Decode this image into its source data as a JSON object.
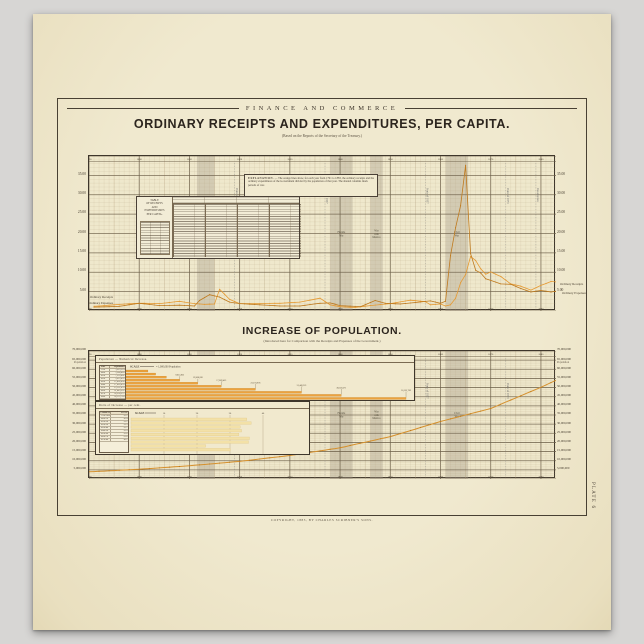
{
  "header": {
    "running_head": "FINANCE AND COMMERCE",
    "title": "ORDINARY RECEIPTS AND EXPENDITURES, PER CAPITA.",
    "subtitle": "(Based on the Reports of the Secretary of the Treasury.)"
  },
  "section2": {
    "title": "INCREASE OF POPULATION.",
    "subtitle": "(Introduced here for Comparison with the Receipts and Expenses of the Government.)"
  },
  "footer": {
    "copyright": "COPYRIGHT, 1883, BY CHARLES SCRIBNER'S SONS.",
    "plate_label": "PLATE 6"
  },
  "explanation_box": {
    "title": "EXPLANATION.",
    "body": "— The orange lines show, for each year from 1791 to 1883, the ordinary receipts and the ordinary expenditures of the Government divided by the population of that year. The shaded columns mark periods of war."
  },
  "top_table": {
    "header_lines": [
      "TABLE",
      "OF RECEIPTS",
      "AND",
      "EXPENDITURES",
      "PER CAPITA."
    ]
  },
  "series_labels": {
    "receipts": "Ordinary Receipts",
    "expenses": "Ordinary Expenses"
  },
  "colors": {
    "paper": "#efe8cc",
    "ink": "#3b332a",
    "grid_fine": "#b3a07c",
    "grid_heavy": "#6e604a",
    "receipts": "#e59a33",
    "expenses": "#bf7a1e",
    "population_line": "#d6902c",
    "war_band": "#a59c8b",
    "bar_orange": "#eca23e",
    "bar_pale": "#f3e1a7"
  },
  "chart_data": [
    {
      "type": "line",
      "title": "Ordinary Receipts and Expenditures, per Capita",
      "x_range": [
        1790,
        1883
      ],
      "x_ticks": [
        1790,
        1800,
        1810,
        1820,
        1830,
        1840,
        1850,
        1860,
        1870,
        1880
      ],
      "ylim": [
        0,
        40
      ],
      "y_ticks": [
        {
          "v": 35,
          "label": "35.00"
        },
        {
          "v": 30,
          "label": "30.00"
        },
        {
          "v": 25,
          "label": "25.00"
        },
        {
          "v": 20,
          "label": "20.00"
        },
        {
          "v": 15,
          "label": "15.00"
        },
        {
          "v": 10,
          "label": "10.00"
        },
        {
          "v": 5,
          "label": "5.00"
        }
      ],
      "grid": "yearly verticals, $1 horizontals, heavy every 5",
      "legend_position": "right and left of frame",
      "war_bands": [
        {
          "label": "War of 1812",
          "start": 1811.5,
          "end": 1815
        },
        {
          "label": "Florida War",
          "start": 1838,
          "end": 1842.5
        },
        {
          "label": "War with Mexico",
          "start": 1846,
          "end": 1848.5
        },
        {
          "label": "Civil War",
          "start": 1861,
          "end": 1865.5
        }
      ],
      "events": [
        {
          "year": 1819,
          "label": "Panic of 1819"
        },
        {
          "year": 1837,
          "label": "Panic of 1837"
        },
        {
          "year": 1857,
          "label": "Panic of 1857"
        },
        {
          "year": 1873,
          "label": "Panic of 1873"
        },
        {
          "year": 1879,
          "label": "Resumption"
        }
      ],
      "series": [
        {
          "name": "Ordinary Receipts",
          "color": "#e59a33",
          "points": [
            [
              1791,
              1.2
            ],
            [
              1796,
              1.7
            ],
            [
              1800,
              2.0
            ],
            [
              1804,
              1.9
            ],
            [
              1808,
              2.5
            ],
            [
              1811,
              1.9
            ],
            [
              1813,
              1.7
            ],
            [
              1815,
              1.8
            ],
            [
              1816,
              5.6
            ],
            [
              1818,
              3.0
            ],
            [
              1820,
              1.9
            ],
            [
              1824,
              1.9
            ],
            [
              1828,
              2.0
            ],
            [
              1832,
              2.3
            ],
            [
              1836,
              3.3
            ],
            [
              1838,
              1.6
            ],
            [
              1840,
              1.1
            ],
            [
              1843,
              0.9
            ],
            [
              1846,
              1.4
            ],
            [
              1850,
              1.9
            ],
            [
              1854,
              2.8
            ],
            [
              1857,
              2.4
            ],
            [
              1858,
              1.6
            ],
            [
              1860,
              1.8
            ],
            [
              1861,
              1.3
            ],
            [
              1862,
              1.6
            ],
            [
              1863,
              3.3
            ],
            [
              1864,
              7.3
            ],
            [
              1865,
              9.4
            ],
            [
              1866,
              14.1
            ],
            [
              1867,
              13.0
            ],
            [
              1868,
              10.9
            ],
            [
              1869,
              9.5
            ],
            [
              1870,
              10.1
            ],
            [
              1872,
              8.9
            ],
            [
              1874,
              7.0
            ],
            [
              1876,
              6.4
            ],
            [
              1878,
              5.4
            ],
            [
              1880,
              6.6
            ],
            [
              1882,
              7.6
            ],
            [
              1883,
              7.5
            ]
          ]
        },
        {
          "name": "Ordinary Expenses",
          "color": "#bf7a1e",
          "points": [
            [
              1791,
              1.0
            ],
            [
              1796,
              1.2
            ],
            [
              1800,
              2.0
            ],
            [
              1804,
              1.4
            ],
            [
              1808,
              1.5
            ],
            [
              1811,
              1.3
            ],
            [
              1812,
              2.7
            ],
            [
              1814,
              4.2
            ],
            [
              1816,
              3.6
            ],
            [
              1818,
              2.3
            ],
            [
              1820,
              1.9
            ],
            [
              1824,
              1.6
            ],
            [
              1828,
              1.3
            ],
            [
              1832,
              1.3
            ],
            [
              1836,
              2.0
            ],
            [
              1838,
              2.1
            ],
            [
              1840,
              1.4
            ],
            [
              1844,
              1.1
            ],
            [
              1847,
              2.7
            ],
            [
              1849,
              2.0
            ],
            [
              1852,
              1.8
            ],
            [
              1855,
              2.2
            ],
            [
              1858,
              2.6
            ],
            [
              1860,
              2.0
            ],
            [
              1861,
              2.5
            ],
            [
              1862,
              14.3
            ],
            [
              1863,
              21.5
            ],
            [
              1864,
              27.2
            ],
            [
              1865,
              37.6
            ],
            [
              1866,
              14.8
            ],
            [
              1867,
              10.5
            ],
            [
              1868,
              9.8
            ],
            [
              1869,
              8.3
            ],
            [
              1870,
              7.9
            ],
            [
              1872,
              7.0
            ],
            [
              1874,
              6.9
            ],
            [
              1876,
              5.8
            ],
            [
              1878,
              4.9
            ],
            [
              1880,
              5.3
            ],
            [
              1882,
              4.9
            ],
            [
              1883,
              5.1
            ]
          ]
        }
      ]
    },
    {
      "type": "line",
      "title": "Increase of Population",
      "x_range": [
        1790,
        1883
      ],
      "x_ticks": [
        1790,
        1800,
        1810,
        1820,
        1830,
        1840,
        1850,
        1860,
        1870,
        1880
      ],
      "ylim_millions": [
        0,
        70
      ],
      "y_ticks": [
        {
          "v": 70,
          "label": "70,000,000"
        },
        {
          "v": 65,
          "label": "65,000,000",
          "sub": "Population"
        },
        {
          "v": 60,
          "label": "60,000,000"
        },
        {
          "v": 55,
          "label": "55,000,000"
        },
        {
          "v": 50,
          "label": "50,000,000"
        },
        {
          "v": 45,
          "label": "45,000,000"
        },
        {
          "v": 40,
          "label": "40,000,000"
        },
        {
          "v": 35,
          "label": "35,000,000"
        },
        {
          "v": 30,
          "label": "30,000,000"
        },
        {
          "v": 25,
          "label": "25,000,000"
        },
        {
          "v": 20,
          "label": "20,000,000"
        },
        {
          "v": 15,
          "label": "15,000,000"
        },
        {
          "v": 10,
          "label": "10,000,000"
        },
        {
          "v": 5,
          "label": "5,000,000"
        }
      ],
      "population_line": {
        "x": [
          1790,
          1800,
          1810,
          1820,
          1830,
          1840,
          1850,
          1860,
          1870,
          1880,
          1883
        ],
        "y_millions": [
          3.93,
          5.31,
          7.24,
          9.63,
          12.87,
          17.07,
          23.19,
          31.44,
          38.56,
          50.16,
          54.0
        ]
      },
      "war_bands": [
        {
          "label": "War of 1812",
          "start": 1811.5,
          "end": 1815
        },
        {
          "label": "Florida War",
          "start": 1838,
          "end": 1842.5
        },
        {
          "label": "War with Mexico",
          "start": 1846,
          "end": 1848.5
        },
        {
          "label": "Civil War",
          "start": 1861,
          "end": 1865.5
        }
      ],
      "events": [
        {
          "year": 1819,
          "label": "Panic of 1819"
        },
        {
          "year": 1837,
          "label": "Panic of 1837"
        },
        {
          "year": 1857,
          "label": "Panic of 1857"
        },
        {
          "year": 1873,
          "label": "Panic of 1873"
        }
      ],
      "insets": [
        {
          "header": "Population — Numerical Increase.",
          "scale_label": "SCALE",
          "scale_note": "= 1,000,000 Population",
          "table_cols": [
            "Year",
            "Population"
          ],
          "rows": [
            [
              "1790",
              "3,929,214"
            ],
            [
              "1800",
              "5,308,483"
            ],
            [
              "1810",
              "7,239,881"
            ],
            [
              "1820",
              "9,633,822"
            ],
            [
              "1830",
              "12,866,020"
            ],
            [
              "1840",
              "17,069,453"
            ],
            [
              "1850",
              "23,191,876"
            ],
            [
              "1860",
              "31,443,321"
            ],
            [
              "1870",
              "38,558,371"
            ],
            [
              "1880",
              "50,155,783"
            ]
          ],
          "bar_values_millions": [
            3.93,
            5.31,
            7.24,
            9.63,
            12.87,
            17.07,
            23.19,
            31.44,
            38.56,
            50.16
          ],
          "bar_color": "#eca23e"
        },
        {
          "header": "Ratio of Increase — per cent.",
          "scale_label": "SCALE",
          "scale_ticks": [
            "10",
            "20",
            "30",
            "40"
          ],
          "table_cols": [
            "Census Years",
            "Per ct."
          ],
          "rows": [
            [
              "1790-1800",
              "35.1"
            ],
            [
              "1800-10",
              "36.4"
            ],
            [
              "1810-20",
              "33.1"
            ],
            [
              "1820-30",
              "33.5"
            ],
            [
              "1830-40",
              "32.7"
            ],
            [
              "1840-50",
              "35.9"
            ],
            [
              "1850-60",
              "35.6"
            ],
            [
              "1860-70",
              "22.6"
            ],
            [
              "1870-80",
              "30.1"
            ]
          ],
          "bar_values_pct": [
            35.1,
            36.4,
            33.1,
            33.5,
            32.7,
            35.9,
            35.6,
            22.6,
            30.1
          ],
          "bar_color": "#f3e1a7"
        }
      ]
    }
  ]
}
